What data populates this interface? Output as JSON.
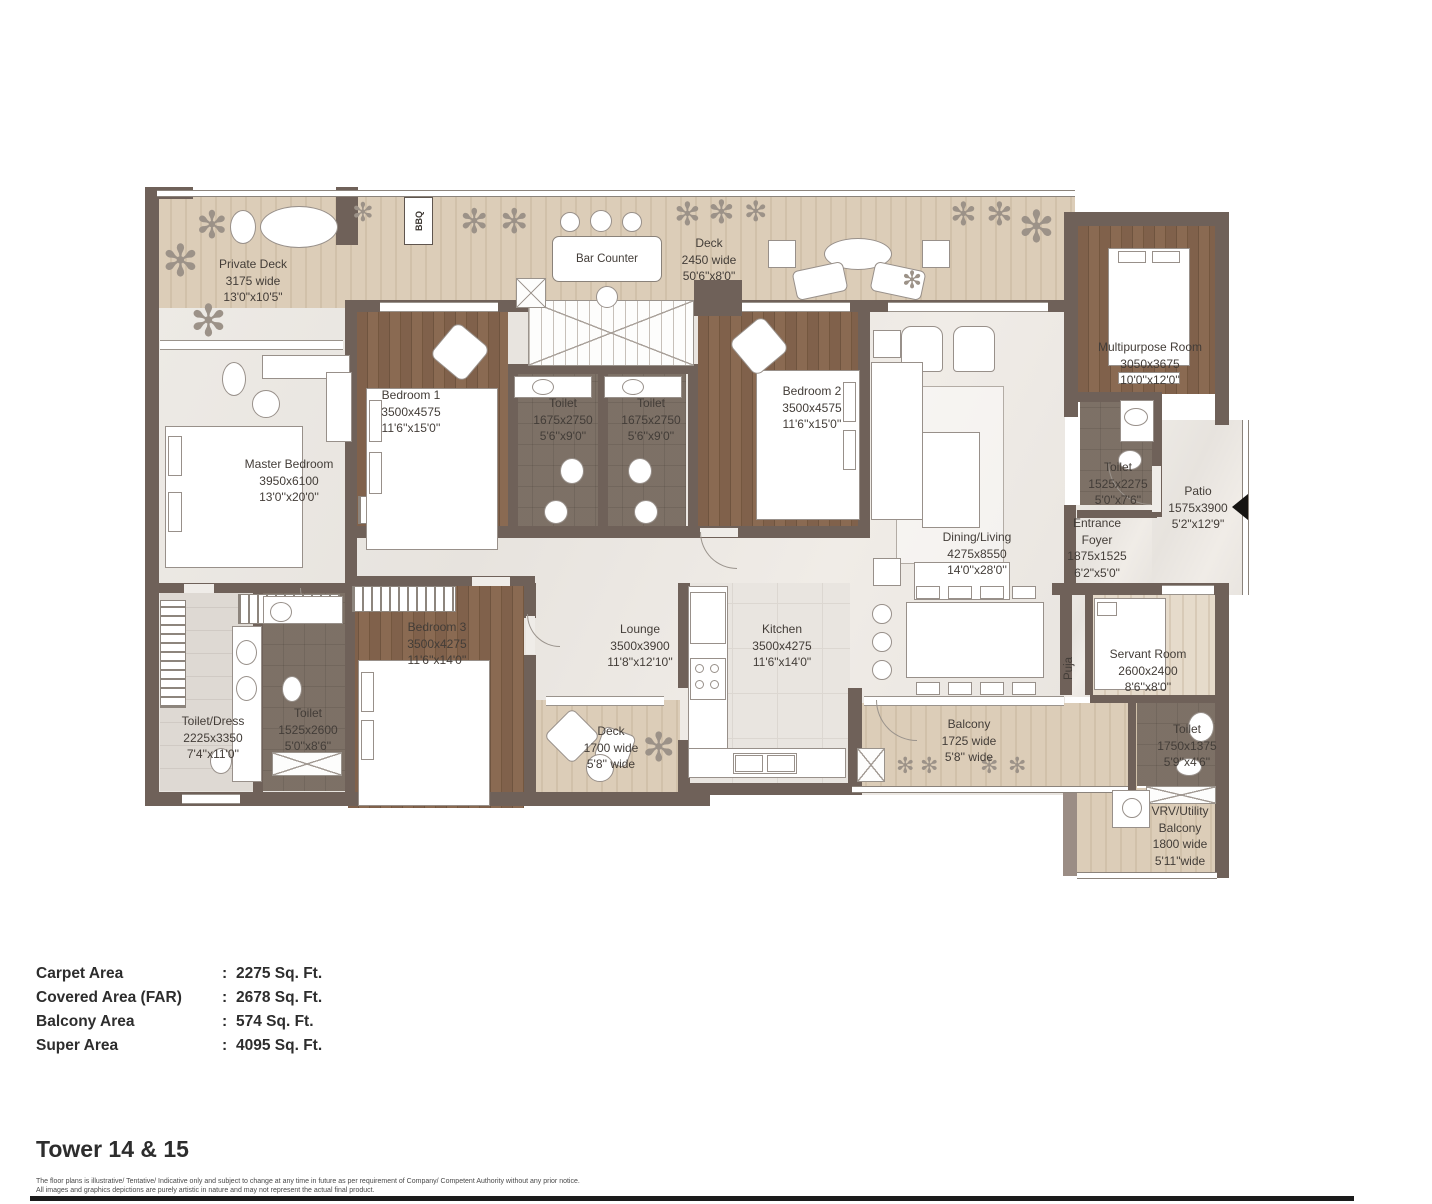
{
  "plan": {
    "labels": {
      "bbq": "BBQ",
      "bar_counter": "Bar Counter",
      "puja": "Puja"
    },
    "rooms": [
      {
        "name": "Private Deck",
        "l1": "3175 wide",
        "l2": "13'0\"x10'5\""
      },
      {
        "name": "Deck",
        "l1": "2450 wide",
        "l2": "50'6\"x8'0\""
      },
      {
        "name": "Bedroom 1",
        "l1": "3500x4575",
        "l2": "11'6''x15'0''"
      },
      {
        "name": "Toilet",
        "l1": "1675x2750",
        "l2": "5'6''x9'0''"
      },
      {
        "name": "Toilet",
        "l1": "1675x2750",
        "l2": "5'6''x9'0''"
      },
      {
        "name": "Bedroom 2",
        "l1": "3500x4575",
        "l2": "11'6''x15'0''"
      },
      {
        "name": "Master Bedroom",
        "l1": "3950x6100",
        "l2": "13'0''x20'0''"
      },
      {
        "name": "Multipurpose Room",
        "l1": "3050x3675",
        "l2": "10'0''x12'0''"
      },
      {
        "name": "Toilet",
        "l1": "1525x2275",
        "l2": "5'0''x7'6''"
      },
      {
        "name": "Patio",
        "l1": "1575x3900",
        "l2": "5'2\"x12'9\""
      },
      {
        "name": "Dining/Living",
        "l1": "4275x8550",
        "l2": "14'0''x28'0''"
      },
      {
        "name": "Entrance",
        "n2": "Foyer",
        "l1": "1875x1525",
        "l2": "6'2\"x5'0\""
      },
      {
        "name": "Bedroom 3",
        "l1": "3500x4275",
        "l2": "11'6''x14'0''"
      },
      {
        "name": "Lounge",
        "l1": "3500x3900",
        "l2": "11'8''x12'10''"
      },
      {
        "name": "Kitchen",
        "l1": "3500x4275",
        "l2": "11'6\"x14'0\""
      },
      {
        "name": "Deck",
        "l1": "1700 wide",
        "l2": "5'8'' wide"
      },
      {
        "name": "Toilet/Dress",
        "l1": "2225x3350",
        "l2": "7'4''x11'0''"
      },
      {
        "name": "Toilet",
        "l1": "1525x2600",
        "l2": "5'0''x8'6''"
      },
      {
        "name": "Balcony",
        "l1": "1725 wide",
        "l2": "5'8'' wide"
      },
      {
        "name": "Servant Room",
        "l1": "2600x2400",
        "l2": "8'6''x8'0''"
      },
      {
        "name": "Toilet",
        "l1": "1750x1375",
        "l2": "5'9''x4'6''"
      },
      {
        "name": "VRV/Utility",
        "n2": "Balcony",
        "l1": "1800 wide",
        "l2": "5'11\"wide"
      }
    ]
  },
  "areas": {
    "rows": [
      {
        "label": "Carpet Area",
        "sep": ":",
        "value": "2275 Sq. Ft."
      },
      {
        "label": "Covered Area (FAR)",
        "sep": ":",
        "value": "2678 Sq. Ft."
      },
      {
        "label": "Balcony Area",
        "sep": ":",
        "value": "574 Sq. Ft."
      },
      {
        "label": "Super Area",
        "sep": ":",
        "value": "4095 Sq. Ft."
      }
    ]
  },
  "footer": {
    "title": "Tower 14 & 15",
    "disclaimer_line1": "The floor plans is illustrative/ Tentative/ Indicative only and subject to change at any time in future as per requirement of Company/ Competent Authority without any prior notice.",
    "disclaimer_line2": "All images and graphics depictions are purely artistic in nature and may not represent the actual final product."
  }
}
